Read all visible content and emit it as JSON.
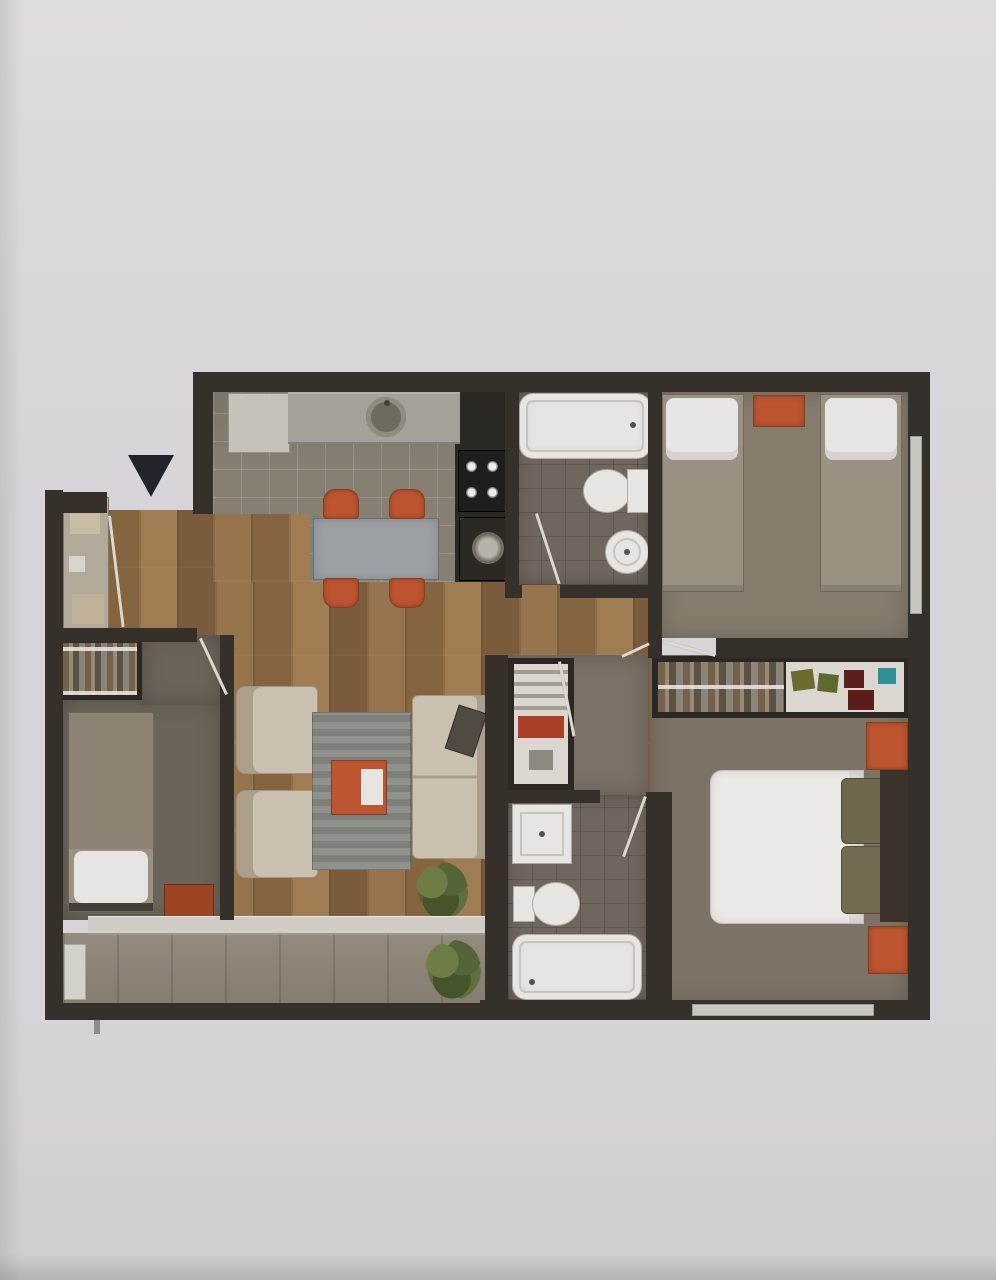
{
  "palette": {
    "paper": "#d7d4d9",
    "paper_top": "#dedbe0",
    "paper_bottom": "#cfccd2",
    "wall": "#36302a",
    "wall_dark": "#2b2723",
    "wood": "#8d6c48",
    "wood_light": "#a07c52",
    "wood_dark": "#7a5c3c",
    "kitchen_tile": "#868073",
    "bath_floor": "#6f675e",
    "carpet_twin": "#857c6e",
    "carpet_master": "#7c7366",
    "carpet_hall": "#7b7267",
    "carpet_bedroom2": "#6b6459",
    "balcony_floor": "#8d8476",
    "fixture_white": "#e7e5e1",
    "fixture_shadow": "#c7c4be",
    "furniture_beige": "#c9c0af",
    "furniture_beige_dark": "#ab9f8c",
    "accent_orange": "#bd5630",
    "accent_orange_dark": "#9c4423",
    "rug_grey": "#8f918c",
    "rug_grey_dark": "#7e807a",
    "table_grey": "#9aa0a3",
    "plant_green": "#5f7040",
    "plant_green_dark": "#46542c",
    "window_light": "#c9c6c1",
    "arrow_black": "#23242c",
    "duvet_white": "#ebe9e5",
    "pillow_olive": "#6f664e",
    "blanket_grey": "#9a9183",
    "headboard_dark": "#3a332b",
    "shelf_white": "#dbd7d0",
    "shelf_red": "#ab3f28",
    "wardrobe_item_olive": "#6b6b2f",
    "wardrobe_item_green": "#5e6a2c",
    "wardrobe_item_red": "#5c1f1c",
    "wardrobe_item_teal": "#2f8f96",
    "wardrobe_box_red": "#5a1d18",
    "door_swing": "#dcd7cf"
  },
  "plan": {
    "type": "apartment-floor-plan-rendering",
    "entry_arrow_direction": "down",
    "rooms": [
      {
        "name": "kitchen-dining",
        "furniture": [
          "refrigerator",
          "counter-with-sink",
          "cooktop-4-burners",
          "washing-machine",
          "dining-table",
          "dining-chair",
          "dining-chair",
          "dining-chair",
          "dining-chair"
        ]
      },
      {
        "name": "bathroom-top",
        "furniture": [
          "bathtub",
          "toilet",
          "bidet"
        ]
      },
      {
        "name": "bedroom-twin",
        "furniture": [
          "single-bed",
          "single-bed",
          "nightstand",
          "window"
        ]
      },
      {
        "name": "entry-hall",
        "furniture": [
          "entry-arrow",
          "utility-closet",
          "wardrobe"
        ]
      },
      {
        "name": "bedroom-left",
        "furniture": [
          "single-bed",
          "nightstand"
        ]
      },
      {
        "name": "living-room",
        "furniture": [
          "armchair",
          "armchair",
          "area-rug",
          "coffee-table",
          "sofa",
          "sofa-cushion",
          "plant"
        ]
      },
      {
        "name": "inner-hall",
        "furniture": [
          "shelf-unit"
        ]
      },
      {
        "name": "bathroom-bottom",
        "furniture": [
          "shower",
          "toilet",
          "bathtub"
        ]
      },
      {
        "name": "bedroom-master",
        "furniture": [
          "wardrobe",
          "double-bed",
          "pillow",
          "pillow",
          "nightstand",
          "nightstand",
          "window"
        ]
      },
      {
        "name": "balcony",
        "furniture": [
          "plant",
          "sliding-door-ledge"
        ]
      }
    ]
  }
}
